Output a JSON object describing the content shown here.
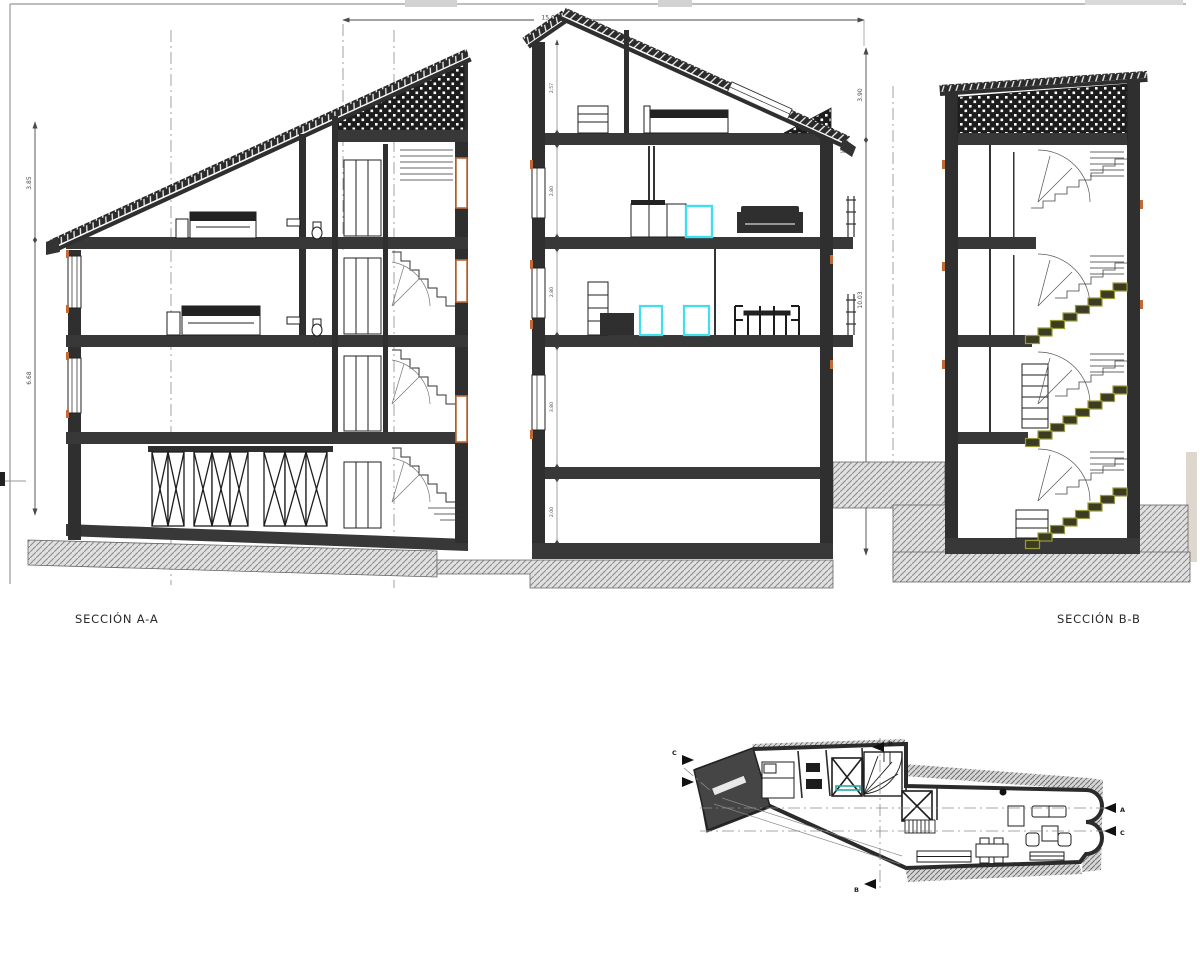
{
  "drawing": {
    "labels": {
      "section_a": "SECCIÓN A-A",
      "section_b": "SECCIÓN B-B"
    },
    "dims": {
      "top_width": "15.06",
      "left": [
        "3.85",
        "6.68"
      ],
      "right": [
        "3.90",
        "10.03"
      ],
      "chain": [
        "2.57",
        "2.80",
        "2.80",
        "3.80",
        "2.00"
      ],
      "slab": ".30",
      "base": ".40",
      "eave_note": "50"
    },
    "markers": {
      "a": "A",
      "b": "B",
      "c": "C"
    },
    "colors": {
      "ink": "#1f1f1f",
      "slab": "#383838",
      "accent_orange": "#c06a38",
      "appliance_cyan": "#3fe0ea",
      "stair_olive": "#8d8d33",
      "hatch_gray": "#8a8a8a",
      "frame_gray": "#a8a8a8",
      "plan_teal": "#2aa7a0"
    }
  }
}
